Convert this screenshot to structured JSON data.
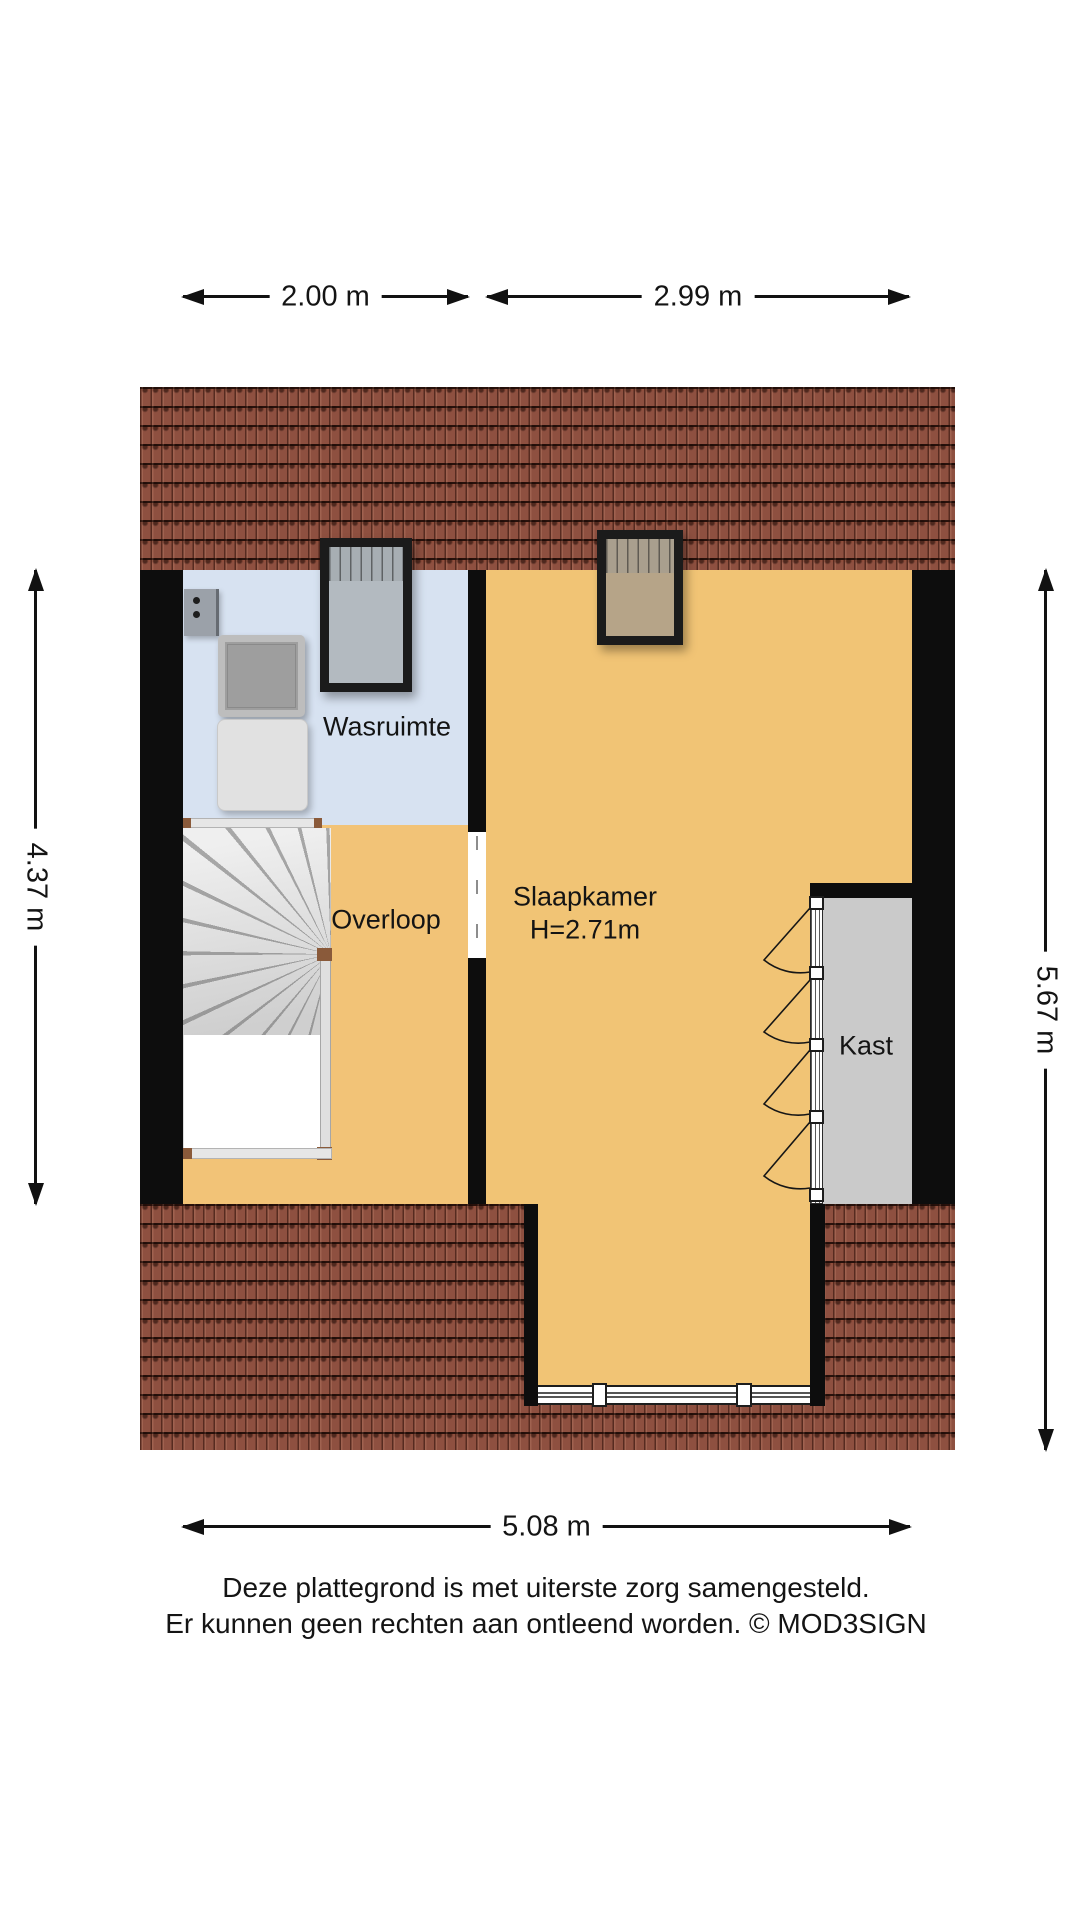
{
  "dimensions": {
    "top_left": "2.00 m",
    "top_right": "2.99 m",
    "left": "4.37 m",
    "right": "5.67 m",
    "bottom": "5.08 m"
  },
  "rooms": {
    "wasruimte": {
      "label": "Wasruimte"
    },
    "overloop": {
      "label": "Overloop"
    },
    "slaapkamer": {
      "label": "Slaapkamer",
      "ceiling_height": "H=2.71m"
    },
    "kast": {
      "label": "Kast"
    }
  },
  "disclaimer": {
    "line1": "Deze plattegrond is met uiterste zorg samengesteld.",
    "line2": "Er kunnen geen rechten aan ontleend worden. © MOD3SIGN"
  },
  "colors": {
    "roof-tile": "#8e5040",
    "wall": "#0d0d0d",
    "wasruimte-floor": "#d7e2f1",
    "overloop-floor": "#f2c377",
    "slaapkamer-floor": "#f1c475",
    "kast-floor": "#cacaca",
    "text": "#141414"
  }
}
